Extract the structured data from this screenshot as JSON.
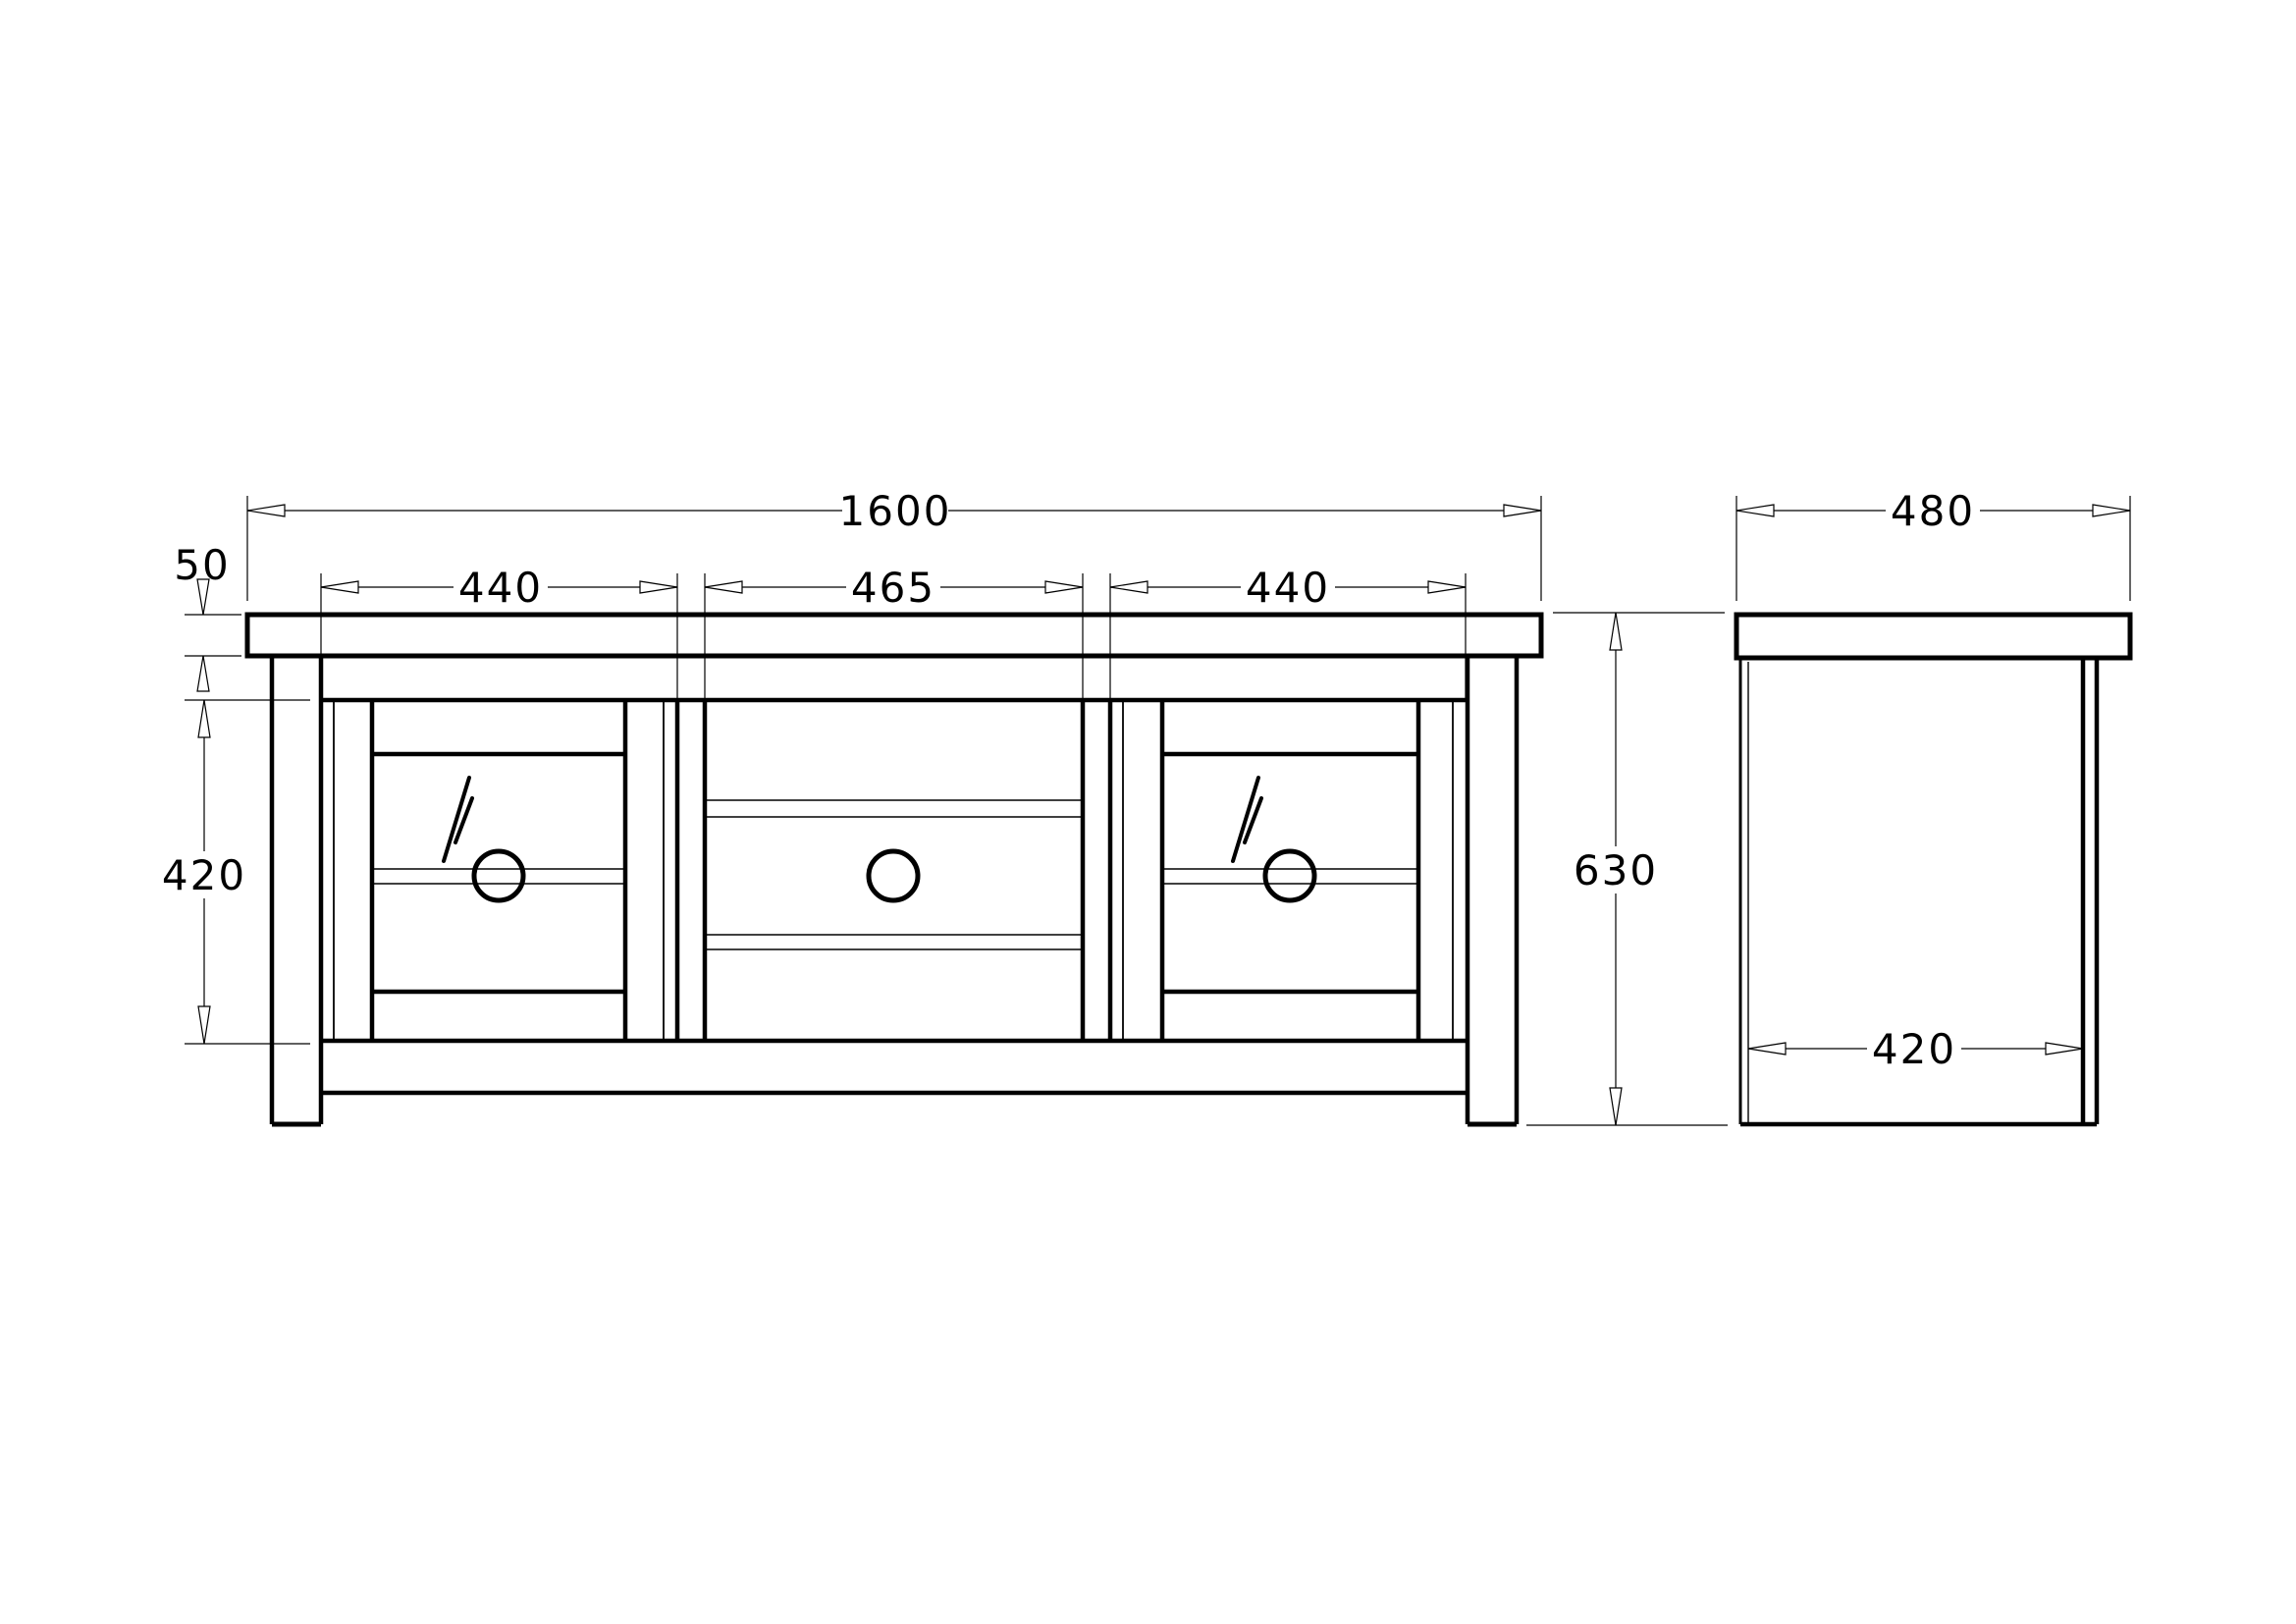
{
  "meta": {
    "background_color": "#ffffff",
    "line_color": "#000000",
    "drawing_type": "orthographic-furniture-drawing"
  },
  "front_view": {
    "overall_width": "1600",
    "top_thickness": "50",
    "left_door_width": "440",
    "center_section_width": "465",
    "right_door_width": "440",
    "opening_height": "420",
    "overall_height": "630"
  },
  "side_view": {
    "overall_depth": "480",
    "inner_depth": "420"
  }
}
